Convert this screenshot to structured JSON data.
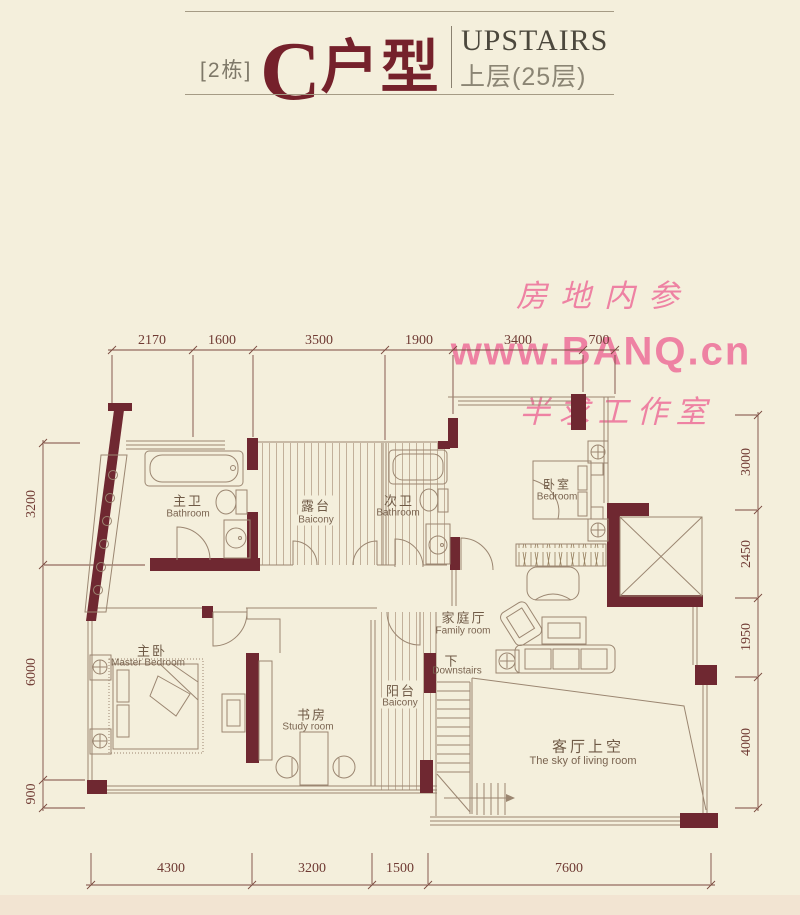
{
  "header": {
    "building_tag": "[2栋]",
    "unit_letter": "C",
    "unit_suffix": "户型",
    "floor_en": "UPSTAIRS",
    "floor_zh": "上层(25层)"
  },
  "watermarks": {
    "wm1": "房地内参",
    "wm2": "www.BANQ.cn",
    "wm3": "半求工作室"
  },
  "rooms": {
    "master_bath": {
      "zh": "主卫",
      "en": "Bathroom"
    },
    "terrace": {
      "zh": "露台",
      "en": "Baicony"
    },
    "second_bath": {
      "zh": "次卫",
      "en": "Bathroom"
    },
    "bedroom": {
      "zh": "卧室",
      "en": "Bedroom"
    },
    "master_bedroom": {
      "zh": "主卧",
      "en": "Master Bedroom"
    },
    "study": {
      "zh": "书房",
      "en": "Study room"
    },
    "balcony": {
      "zh": "阳台",
      "en": "Baicony"
    },
    "family_room": {
      "zh": "家庭厅",
      "en": "Family room"
    },
    "stairs": {
      "zh": "下",
      "en": "Downstairs"
    },
    "living_void": {
      "zh": "客厅上空",
      "en": "The sky of living room"
    }
  },
  "dimensions": {
    "top": [
      "2170",
      "1600",
      "3500",
      "1900",
      "3400",
      "700"
    ],
    "left": [
      "3200",
      "6000",
      "900"
    ],
    "right": [
      "3000",
      "2450",
      "1950",
      "4000"
    ],
    "bottom": [
      "4300",
      "3200",
      "1500",
      "7600"
    ]
  },
  "colors": {
    "background": "#f4efdc",
    "wall_maroon": "#6f2831",
    "thin_line": "#9b8671",
    "dim_color": "#6f3a33",
    "title_red": "#75212b",
    "watermark_pink": "#ee6f9a"
  }
}
